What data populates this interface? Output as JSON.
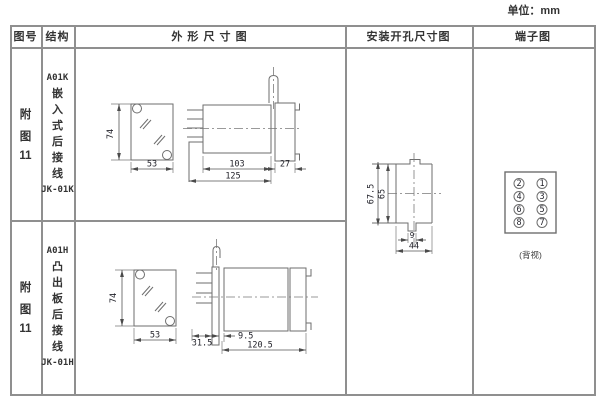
{
  "unit_label": "单位：mm",
  "table_headers": {
    "figure_no": "图号",
    "structure": "结构",
    "outline": "外 形 尺 寸 图",
    "mounting": "安装开孔尺寸图",
    "terminal": "端子图"
  },
  "rows": [
    {
      "figure_no": [
        "附",
        "图",
        "11"
      ],
      "model": "A01K",
      "structure_chars": [
        "嵌",
        "入",
        "式",
        "后",
        "接",
        "线"
      ],
      "code": "JK-01K",
      "dims": {
        "front_height": "74",
        "front_width": "53",
        "body_depth": "103",
        "panel_depth": "27",
        "total_depth": "125"
      }
    },
    {
      "figure_no": [
        "附",
        "图",
        "11"
      ],
      "model": "A01H",
      "structure_chars": [
        "凸",
        "出",
        "板",
        "后",
        "接",
        "线"
      ],
      "code": "JK-01H",
      "dims": {
        "front_height": "74",
        "front_width": "53",
        "behind_panel_depth": "31.5",
        "plate_to_body": "9.5",
        "projection_depth": "120.5"
      }
    }
  ],
  "mounting_hole": {
    "dims": {
      "outer_height": "67.5",
      "cutout_height": "65",
      "notch_width": "9",
      "cutout_width": "44"
    }
  },
  "terminal_diagram": {
    "left_column": [
      "2",
      "4",
      "6",
      "8"
    ],
    "right_column": [
      "1",
      "3",
      "5",
      "7"
    ],
    "caption": "(背视)"
  },
  "colors": {
    "drawing_line": "#6e6e6e",
    "table_border": "#8f8f8f",
    "text": "#3a3a3a",
    "dim_text": "#23232b"
  }
}
